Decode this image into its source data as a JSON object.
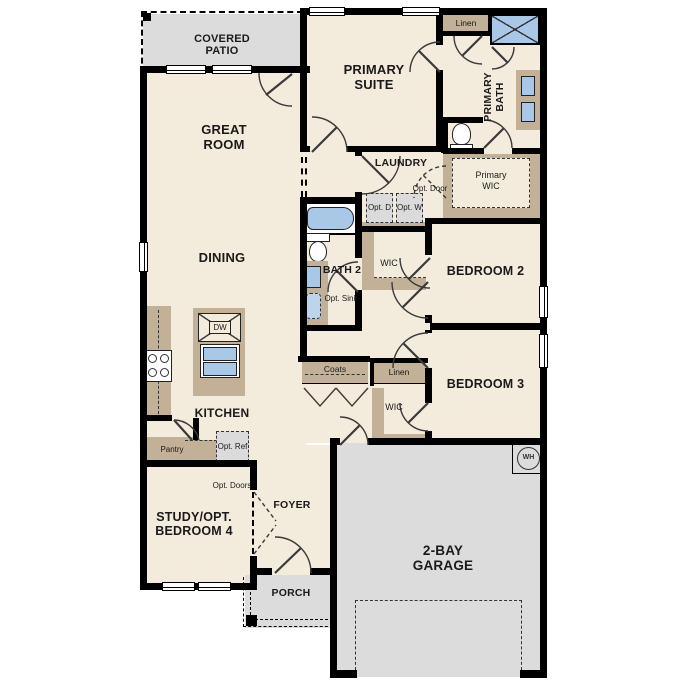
{
  "plan_title": "single-story floor plan",
  "colors": {
    "room_fill": "#f3ebdb",
    "outdoor_fill": "#dcdcdc",
    "cabinet_tan": "#c2b097",
    "fixture_blue": "#a9c7e6",
    "wall": "#000000",
    "optional_box_fill": "#dbdbdb"
  },
  "labels": {
    "covered_patio": "COVERED PATIO",
    "great_room": "GREAT ROOM",
    "primary_suite": "PRIMARY SUITE",
    "linen_upper": "Linen",
    "primary_bath": "PRIMARY BATH",
    "laundry": "LAUNDRY",
    "opt_door": "Opt. Door",
    "opt_dryer": "Opt. D",
    "opt_washer": "Opt. W",
    "primary_wic": "Primary WIC",
    "dining": "DINING",
    "bath2": "BATH 2",
    "opt_sink": "Opt. Sink",
    "wic_bedroom2": "WIC",
    "bedroom2": "BEDROOM 2",
    "coats": "Coats",
    "linen_lower": "Linen",
    "wic_bedroom3": "WIC",
    "bedroom3": "BEDROOM 3",
    "kitchen": "KITCHEN",
    "dishwasher": "DW",
    "pantry": "Pantry",
    "opt_ref": "Opt. Ref",
    "opt_doors": "Opt. Doors",
    "study": "STUDY/OPT. BEDROOM 4",
    "foyer": "FOYER",
    "porch": "PORCH",
    "garage": "2-BAY GARAGE",
    "water_heater": "WH"
  }
}
